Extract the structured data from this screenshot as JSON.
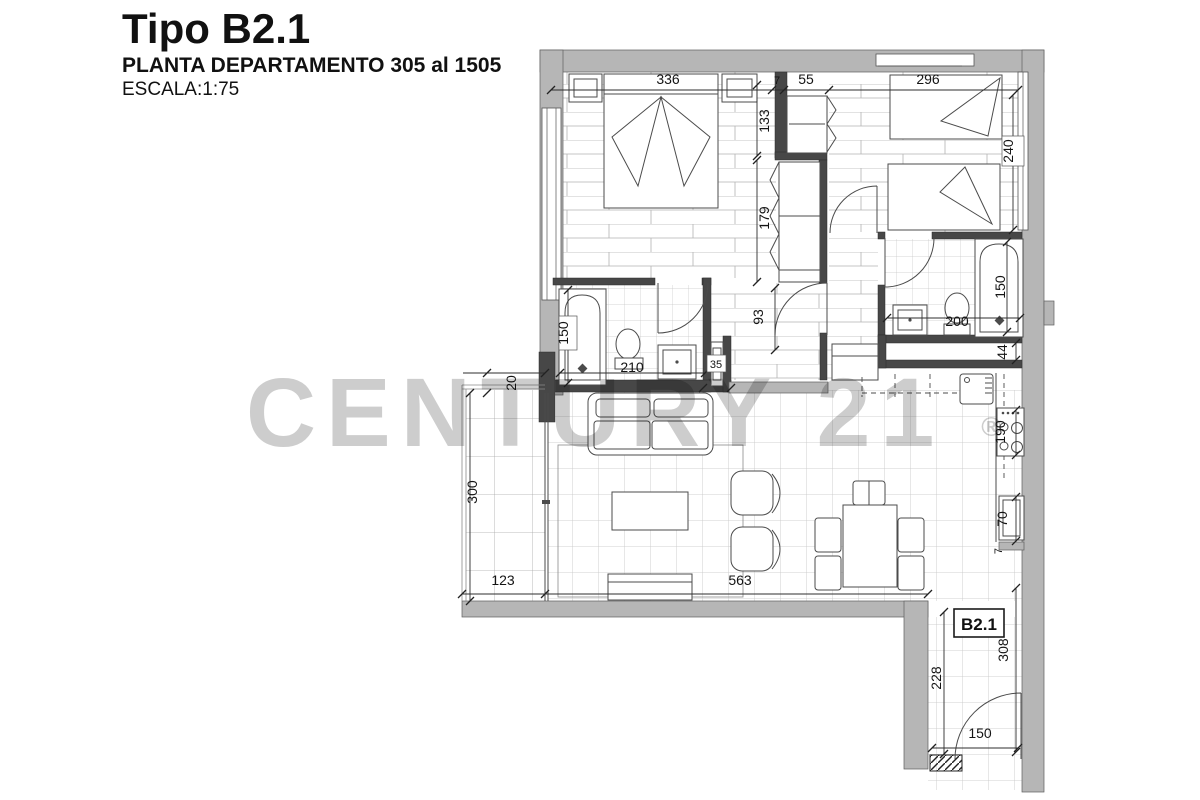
{
  "title": {
    "name": "Tipo B2.1",
    "plan": "PLANTA DEPARTAMENTO 305 al 1505",
    "scale": "ESCALA:1:75"
  },
  "watermark": {
    "brand": "CENTURY 21",
    "registered": "®",
    "color": "#c9c9c9"
  },
  "unit_label": "B2.1",
  "colors": {
    "outer_wall": "#b6b6b6",
    "interior_wall": "#474747",
    "paper": "#ffffff"
  },
  "dims": {
    "bedroom1_width": "336",
    "wall_thickness_top": "7",
    "closet_width": "55",
    "bedroom2_width": "296",
    "closet_b2_depth": "133",
    "bedroom2_depth": "240",
    "closet_b1_depth": "179",
    "bath1_length": "150",
    "hall_door": "93",
    "bath1_width": "210",
    "duct_small": "35",
    "bath2_width": "200",
    "bath2_length": "150",
    "duct": "44",
    "terrace_gap": "20",
    "stove": "190",
    "terrace_depth": "300",
    "fridge": "70",
    "counter_end": "7",
    "terrace_width": "123",
    "living_width": "563",
    "entry_depth_left": "228",
    "entry_depth_right": "308",
    "entry_door": "150"
  }
}
